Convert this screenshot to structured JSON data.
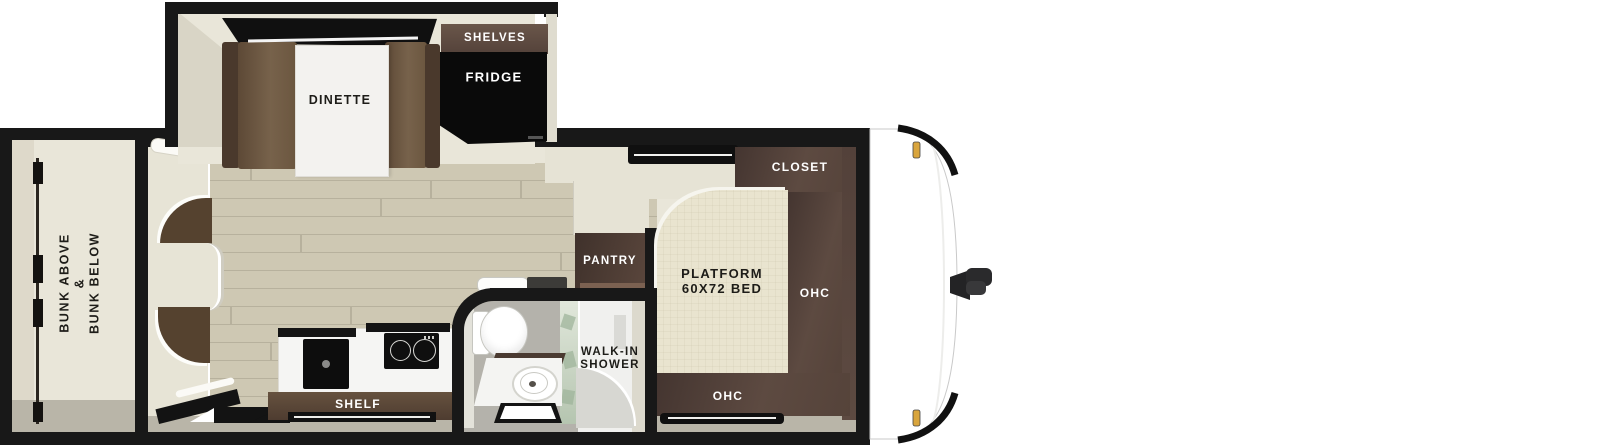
{
  "type": "travel-trailer-floorplan",
  "labels": {
    "dinette": "DINETTE",
    "shelves": "SHELVES",
    "fridge": "FRIDGE",
    "bunk_line1": "BUNK ABOVE",
    "bunk_line2": "&",
    "bunk_line3": "BUNK BELOW",
    "pantry": "PANTRY",
    "closet": "CLOSET",
    "bed_line1": "PLATFORM",
    "bed_line2": "60X72 BED",
    "ohc_right": "OHC",
    "ohc_bottom": "OHC",
    "shower_line1": "WALK-IN",
    "shower_line2": "SHOWER",
    "shelf": "SHELF"
  },
  "colors": {
    "wall_black": "#181818",
    "interior_cream": "#e9e6d9",
    "wood_floor": "#cec8b3",
    "plank_line": "#b7b19d",
    "cabinet_brown": "#5a473e",
    "cabinet_brown_dark": "#46362e",
    "bench_brown": "#6e5843",
    "bed_cream": "#e9e4cf",
    "grey_floor": "#b9b5a8",
    "bath_floor": "#b4b2ab",
    "glass_green": "#a8bca4",
    "marker_yellow": "#d9a53d"
  }
}
